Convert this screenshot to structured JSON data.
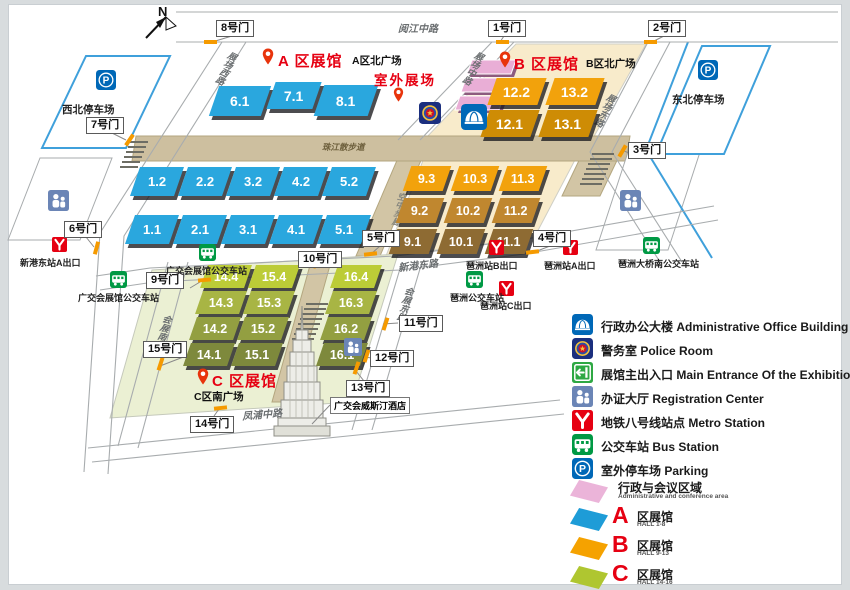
{
  "compass": {
    "n": "N"
  },
  "colors": {
    "hall_a_blue": "#2AA7DE",
    "hall_b_orange": "#F2A20C",
    "hall_b_mid_brown": "#C0872F",
    "hall_b_dark_brown": "#8E6B33",
    "hall_b_north_dark": "#CE8C05",
    "hall_c_green_light": "#BCCC37",
    "hall_c_green_dark": "#7E893C",
    "admin_pink": "#E9AED6",
    "accent_red": "#E60012",
    "walkway_tan": "#CDBF9F",
    "plaza_cream": "#F8EBCB",
    "c_plate_green": "#EBF0D3",
    "parking_blue": "#3FA0DB",
    "gate_mark_orange": "#F59A00"
  },
  "roads": {
    "yuejiangzhonglu": "阅江中路",
    "zhujiangsanbudao": "珠江散步道",
    "zhanchangxilu": "展场西路",
    "zhanchangzhonglu": "展场中路",
    "zhanchangdonglu": "展场东路",
    "kongzhongbulang": "空中步廊",
    "xingangdonglu": "新港东路",
    "huizhandonglu": "会展东路",
    "huizhannanlu": "会展南路",
    "fengpuzhonglu": "凤浦中路"
  },
  "gates": {
    "g1": "1号门",
    "g2": "2号门",
    "g3": "3号门",
    "g4": "4号门",
    "g5": "5号门",
    "g6": "6号门",
    "g7": "7号门",
    "g8": "8号门",
    "g9": "9号门",
    "g10": "10号门",
    "g11": "11号门",
    "g12": "12号门",
    "g13": "13号门",
    "g14": "14号门",
    "g15": "15号门"
  },
  "zoneA": {
    "title": "A 区展馆",
    "plaza": "A区北广场",
    "outdoor": "室外展场",
    "halls": [
      "6.1",
      "7.1",
      "8.1",
      "1.2",
      "2.2",
      "3.2",
      "4.2",
      "5.2",
      "1.1",
      "2.1",
      "3.1",
      "4.1",
      "5.1"
    ]
  },
  "zoneB": {
    "title": "B 区展馆",
    "plaza": "B区北广场",
    "halls": [
      "12.2",
      "13.2",
      "12.1",
      "13.1",
      "9.3",
      "10.3",
      "11.3",
      "9.2",
      "10.2",
      "11.2",
      "9.1",
      "10.1",
      "11.1"
    ]
  },
  "zoneC": {
    "title": "C 区展馆",
    "plaza": "C区南广场",
    "halls": [
      "14.4",
      "15.4",
      "16.4",
      "14.3",
      "15.3",
      "16.3",
      "14.2",
      "15.2",
      "16.2",
      "14.1",
      "15.1",
      "16.1"
    ]
  },
  "stations": {
    "metro_xingang_a": "新港东站A出口",
    "metro_pazhou_b": "琶洲站B出口",
    "metro_pazhou_a": "琶洲站A出口",
    "metro_pazhou_c": "琶洲站C出口",
    "bus_exhibition_1": "广交会展馆公交车站",
    "bus_exhibition_2": "广交会展馆公交车站",
    "bus_pazhou": "琶洲公交车站",
    "bus_pazhou_bridge": "琶洲大桥南公交车站",
    "parking_nw": "西北停车场",
    "parking_ne": "东北停车场"
  },
  "hotel": "广交会威斯汀酒店",
  "legend": {
    "items": [
      {
        "icon": "admin-building-icon",
        "label": "行政办公大楼 Administrative Office Building"
      },
      {
        "icon": "police-icon",
        "label": "警务室 Police Room"
      },
      {
        "icon": "main-entrance-icon",
        "label": "展馆主出入口 Main Entrance Of the Exhibition Hall"
      },
      {
        "icon": "registration-icon",
        "label": "办证大厅 Registration Center"
      },
      {
        "icon": "metro-icon",
        "label": "地铁八号线站点 Metro Station"
      },
      {
        "icon": "bus-icon",
        "label": "公交车站 Bus Station"
      },
      {
        "icon": "parking-icon",
        "label": "室外停车场 Parking"
      }
    ],
    "areas": [
      {
        "letter": "",
        "zh": "行政与会议区域",
        "en": "Administrative and conference area",
        "color": "#EBB4D9"
      },
      {
        "letter": "A",
        "zh": "区展馆",
        "en": "HALL 1-8",
        "color": "#1E9CD7"
      },
      {
        "letter": "B",
        "zh": "区展馆",
        "en": "HALL 9-13",
        "color": "#F5A200"
      },
      {
        "letter": "C",
        "zh": "区展馆",
        "en": "HALL 14-16",
        "color": "#AFC630"
      }
    ]
  }
}
